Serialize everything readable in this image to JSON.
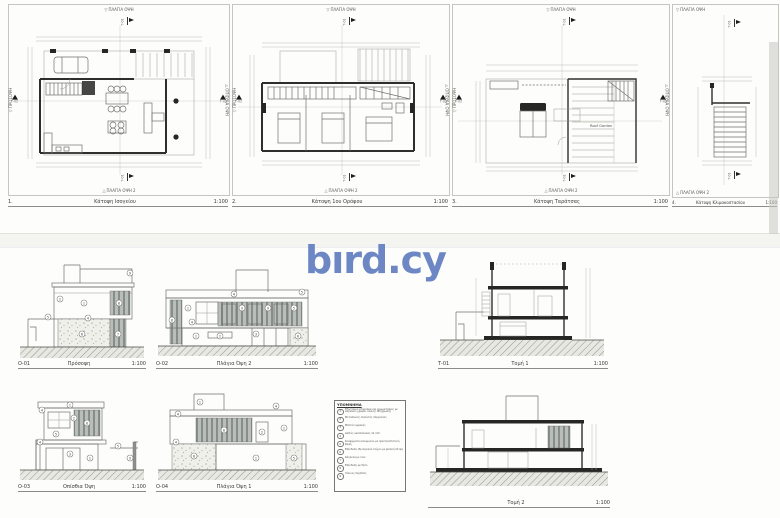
{
  "watermark": {
    "text": "bırd.cy",
    "color": "#6d87c5"
  },
  "sheet1": {
    "plans": [
      {
        "num": "1.",
        "title": "Κάτοψη Ισογείου",
        "scale": "1:100",
        "top_label": "ΠΛΑΓΙΑ ΟΨΗ",
        "bottom_label": "ΠΛΑΓΙΑ ΟΨΗ 2",
        "left_label": "ΠΡΟΣΟΨΗ",
        "right_label": "ΟΠΙΣΘΙΑ ΟΨΗ",
        "section_v": "Τ-01",
        "section_h": "Τ-02"
      },
      {
        "num": "2.",
        "title": "Κάτοψη 1ου Ορόφου",
        "scale": "1:100",
        "top_label": "ΠΛΑΓΙΑ ΟΨΗ",
        "bottom_label": "ΠΛΑΓΙΑ ΟΨΗ 2",
        "left_label": "ΠΡΟΣΟΨΗ",
        "right_label": "ΟΠΙΣΘΙΑ ΟΨΗ",
        "section_v": "Τ-01",
        "section_h": "Τ-02"
      },
      {
        "num": "3.",
        "title": "Κάτοψη Ταράτσας",
        "scale": "1:100",
        "top_label": "ΠΛΑΓΙΑ ΟΨΗ",
        "bottom_label": "ΠΛΑΓΙΑ ΟΨΗ 2",
        "left_label": "ΠΡΟΣΟΨΗ",
        "right_label": "ΟΠΙΣΘΙΑ ΟΨΗ",
        "section_v": "Τ-01",
        "section_h": "Τ-02",
        "roof_garden_label": "Roof Garden"
      },
      {
        "num": "4.",
        "title": "Κάτοψη Κλιμακοστασίου",
        "scale": "1:100",
        "top_label": "ΠΛΑΓΙΑ ΟΨΗ",
        "bottom_label": "ΠΛΑΓΙΑ ΟΨΗ 2",
        "section_v": "Τ-01"
      }
    ]
  },
  "sheet2": {
    "material_refs": [
      "1",
      "2",
      "3",
      "4",
      "5",
      "6",
      "7",
      "8",
      "9"
    ],
    "elevations": [
      {
        "code": "Ο-01",
        "title": "Πρόσοψη",
        "scale": "1:100"
      },
      {
        "code": "Ο-02",
        "title": "Πλάγια Όψη 2",
        "scale": "1:100"
      },
      {
        "code": "Ο-03",
        "title": "Οπίσθια Όψη",
        "scale": "1:100"
      },
      {
        "code": "Ο-04",
        "title": "Πλάγια Όψη 1",
        "scale": "1:100"
      }
    ],
    "sections": [
      {
        "code": "Τ-01",
        "title": "Τομή 1",
        "scale": "1:100"
      },
      {
        "code": "",
        "title": "Τομή 2",
        "scale": "1:100"
      }
    ],
    "legend": {
      "title": "ΥΠΟΜΝΗΜΑ",
      "items": [
        {
          "num": "1",
          "text": "Εξωτερικό επίχρισμα και χρωματισμός με ακρυλικό χρώμα, λευκής απόχρωσης"
        },
        {
          "num": "2",
          "text": "Μεταλλικός σκελετός πέργκολας"
        },
        {
          "num": "3",
          "text": "Μπετόν εμφανές"
        },
        {
          "num": "4",
          "text": "Διπλός υαλοπίνακας 12 mm"
        },
        {
          "num": "5",
          "text": "Κουφώματα αλουμινίου με ηλεκτροστατική βαφή"
        },
        {
          "num": "6",
          "text": "Επένδυση εξωτερικού τοίχου με φυσική πέτρα"
        },
        {
          "num": "7",
          "text": "Κάγκελα με inox"
        },
        {
          "num": "8",
          "text": "Επένδυση με ξύλο"
        },
        {
          "num": "9",
          "text": "Ξύλινες περσίδες"
        }
      ]
    }
  }
}
